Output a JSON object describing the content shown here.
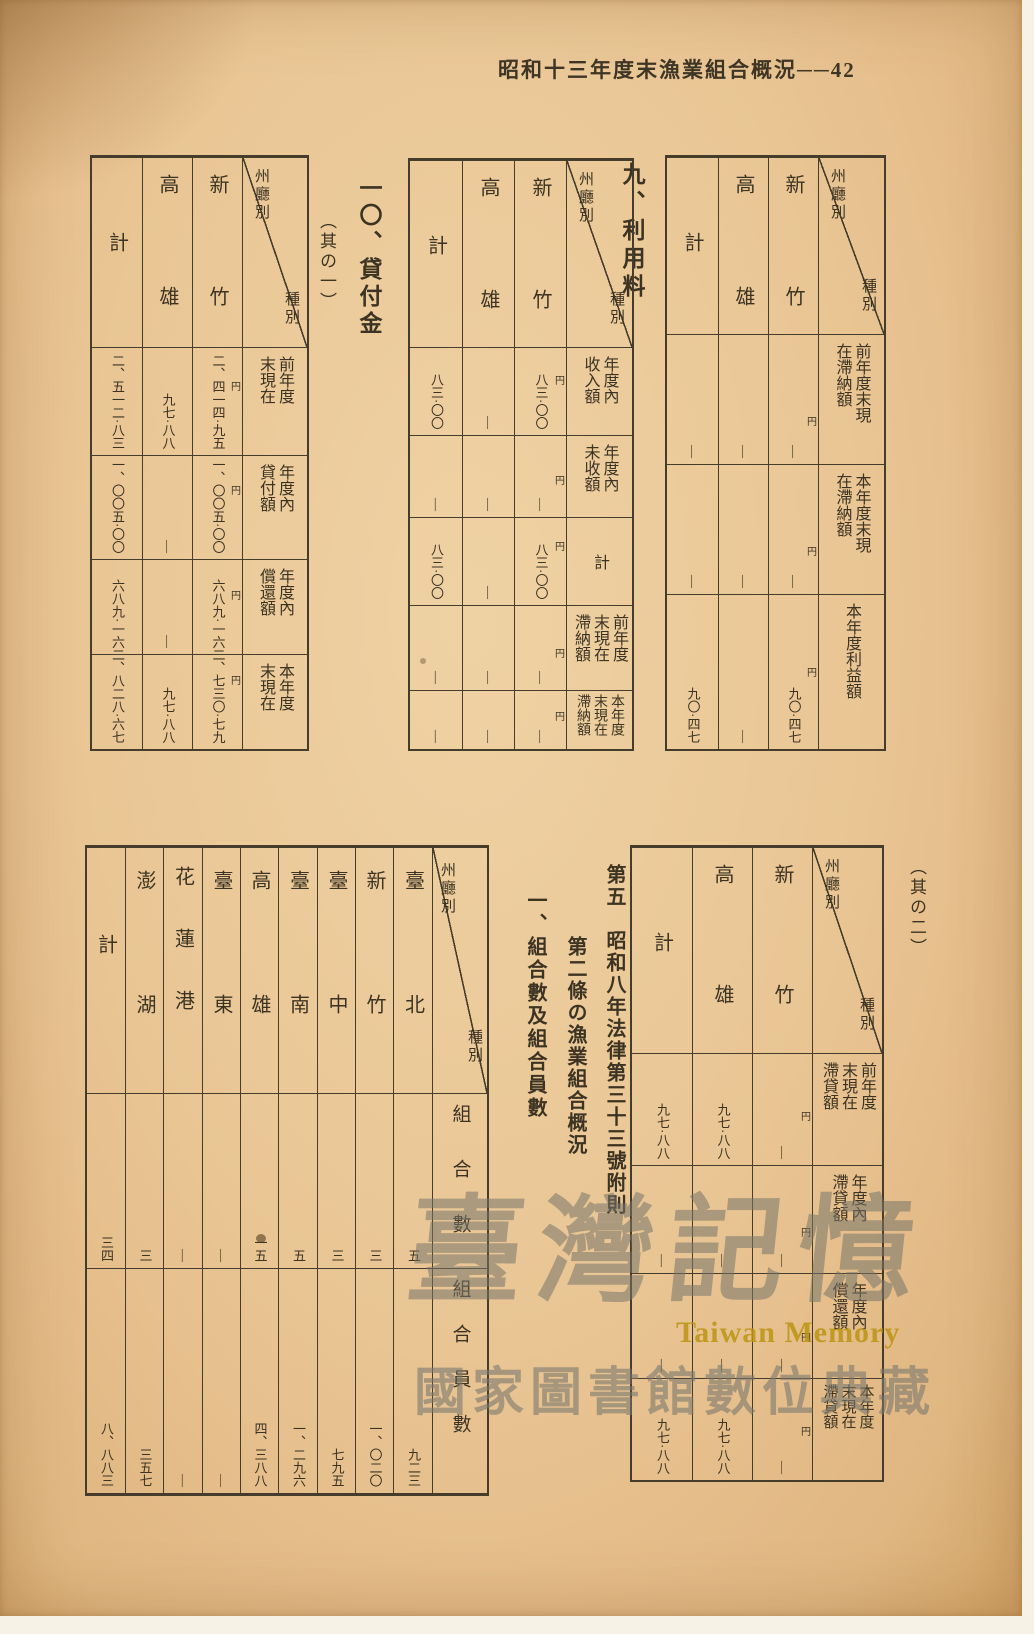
{
  "page": {
    "header": "昭和十三年度末漁業組合概況──42"
  },
  "labels": {
    "usage_fee": "九、利用料",
    "loans": "一〇、貸付金",
    "part1": "（其の一）",
    "part2": "（其の二）",
    "section5_line1": "第五　昭和八年法律第三十三號附則",
    "section5_line2": "第二條の漁業組合概況",
    "section5_sub": "一、組合數及組合員數"
  },
  "diagonal": {
    "top": "州廳別",
    "bottom": "種別"
  },
  "tables": {
    "prev": {
      "cols": [
        "新竹",
        "高雄",
        "計"
      ],
      "rows": [
        {
          "label": [
            "前年度末現",
            "在滯納額"
          ],
          "yen": "円",
          "cells": [
            "—",
            "—",
            "—"
          ]
        },
        {
          "label": [
            "本年度末現",
            "在滯納額"
          ],
          "yen": "円",
          "cells": [
            "—",
            "—",
            "—"
          ]
        },
        {
          "label": [
            "本年度利益額"
          ],
          "yen": "円",
          "cells": [
            "九〇·四七",
            "—",
            "九〇·四七"
          ]
        }
      ]
    },
    "usage": {
      "cols": [
        "新竹",
        "高雄",
        "計"
      ],
      "rows": [
        {
          "label": [
            "年度內",
            "收入額"
          ],
          "yen": "円",
          "cells": [
            "八三·〇〇",
            "—",
            "八三·〇〇"
          ]
        },
        {
          "label": [
            "年度內",
            "未收額"
          ],
          "yen": "円",
          "cells": [
            "—",
            "—",
            "—"
          ]
        },
        {
          "label": [
            "計"
          ],
          "yen": "円",
          "cells": [
            "八三·〇〇",
            "—",
            "八三·〇〇"
          ]
        },
        {
          "label": [
            "前年度",
            "末現在",
            "滯納額"
          ],
          "yen": "円",
          "cells": [
            "—",
            "—",
            "—"
          ]
        },
        {
          "label": [
            "本年度",
            "末現在",
            "滯納額"
          ],
          "yen": "円",
          "cells": [
            "—",
            "—",
            "—"
          ]
        }
      ]
    },
    "loans1": {
      "cols": [
        "新竹",
        "高雄",
        "計"
      ],
      "rows": [
        {
          "label": [
            "前年度",
            "末現在"
          ],
          "yen": "円",
          "cells": [
            "二、四一四·九五",
            "九七·八八",
            "二、五一二·八三"
          ]
        },
        {
          "label": [
            "年度內",
            "貸付額"
          ],
          "yen": "円",
          "cells": [
            "一、〇〇五·〇〇",
            "—",
            "一、〇〇五·〇〇"
          ]
        },
        {
          "label": [
            "年度內",
            "償還額"
          ],
          "yen": "円",
          "cells": [
            "六八九·一六",
            "—",
            "六八九·一六"
          ]
        },
        {
          "label": [
            "本年度",
            "末現在"
          ],
          "yen": "円",
          "cells": [
            "二、七三〇·七九",
            "九七·八八",
            "二、八二八·六七"
          ]
        }
      ]
    },
    "loans2": {
      "cols": [
        "新竹",
        "高雄",
        "計"
      ],
      "rows": [
        {
          "label": [
            "前年度",
            "末現在",
            "滯貸額"
          ],
          "yen": "円",
          "cells": [
            "—",
            "九七·八八",
            "九七·八八"
          ]
        },
        {
          "label": [
            "年度內",
            "滯貸額"
          ],
          "yen": "円",
          "cells": [
            "—",
            "—",
            "—"
          ]
        },
        {
          "label": [
            "年度內",
            "償還額"
          ],
          "yen": "円",
          "cells": [
            "—",
            "—",
            "—"
          ]
        },
        {
          "label": [
            "本年度",
            "末現在",
            "滯貸額"
          ],
          "yen": "円",
          "cells": [
            "—",
            "九七·八八",
            "九七·八八"
          ]
        }
      ]
    },
    "assoc": {
      "cols": [
        "臺北",
        "新竹",
        "臺中",
        "臺南",
        "高雄",
        "臺東",
        "花蓮港",
        "澎湖",
        "計"
      ],
      "rows": [
        {
          "label": "組合數",
          "cells": [
            "五",
            "三",
            "三",
            "五",
            "一五",
            "—",
            "—",
            "三",
            "三四"
          ]
        },
        {
          "label": "組合員數",
          "cells": [
            "九二三",
            "一、〇二〇",
            "七九五",
            "一、二九六",
            "四、三八八",
            "—",
            "—",
            "三五七",
            "八、八八三"
          ]
        }
      ]
    }
  },
  "watermark": {
    "script": "臺灣記憶",
    "en": "Taiwan Memory",
    "org": "國家圖書館數位典藏"
  }
}
